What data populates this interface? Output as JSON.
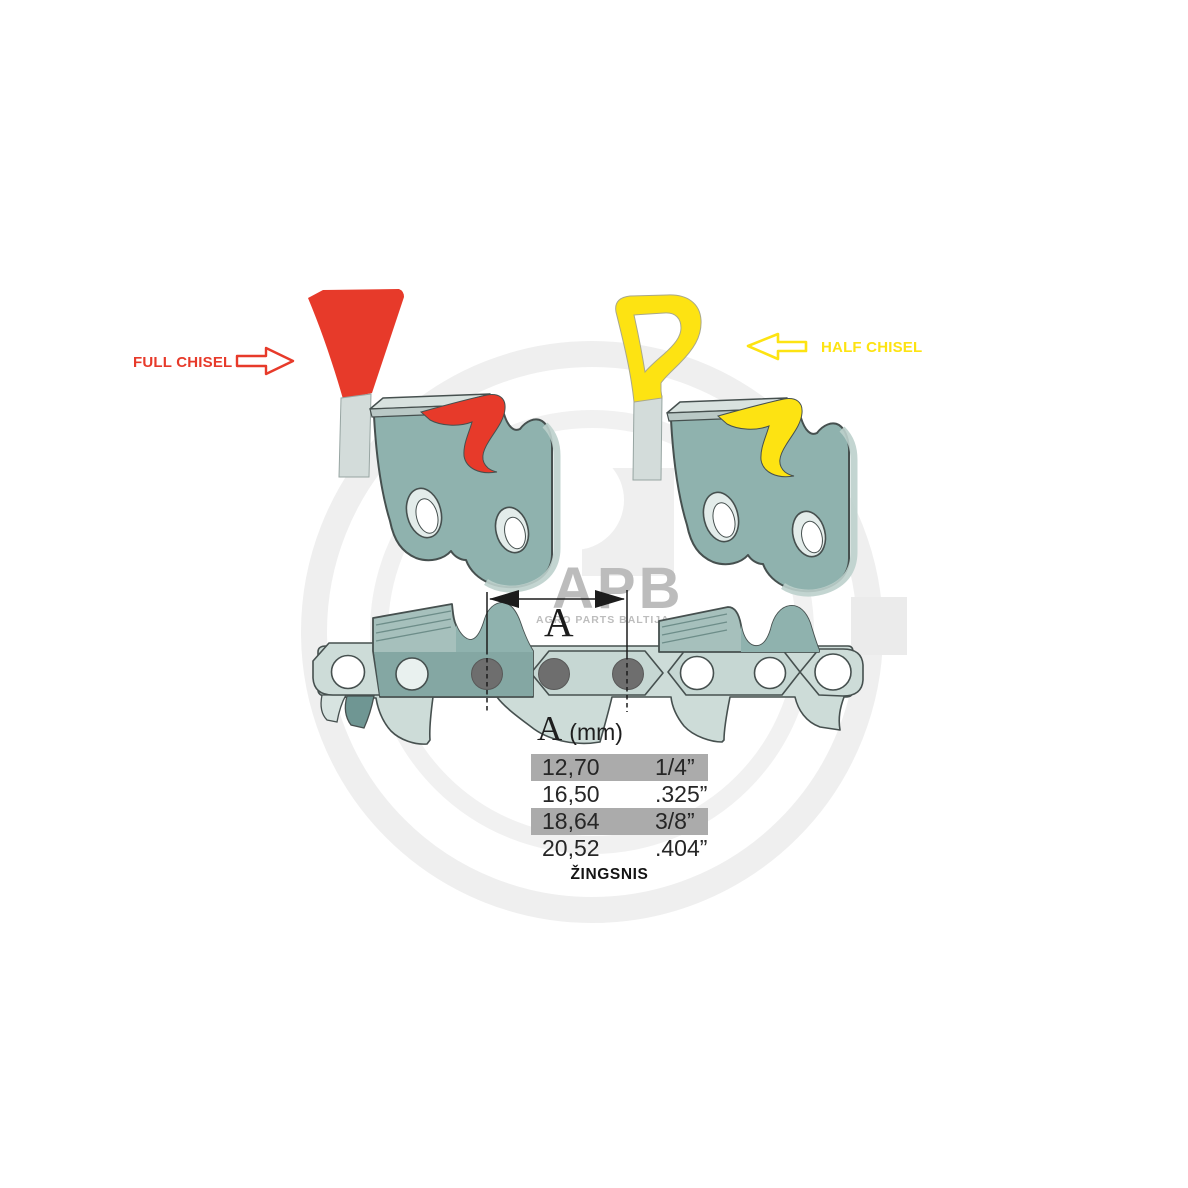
{
  "labels": {
    "full_chisel": "FULL CHISEL",
    "half_chisel": "HALF CHISEL",
    "dimension_letter": "A",
    "pitch_caption": "ŽINGSNIS"
  },
  "watermark": {
    "brand": "APB",
    "brand_subtitle": "AGRO PARTS BALTIJA"
  },
  "pitch_table": {
    "header": {
      "symbol": "A",
      "unit": "(mm)"
    },
    "columns": [
      "millimeters",
      "inches"
    ],
    "rows": [
      {
        "mm": "12,70",
        "inches": "1/4”",
        "highlighted": true
      },
      {
        "mm": "16,50",
        "inches": ".325”",
        "highlighted": false
      },
      {
        "mm": "18,64",
        "inches": "3/8”",
        "highlighted": true
      },
      {
        "mm": "20,52",
        "inches": ".404”",
        "highlighted": false
      }
    ]
  },
  "colors": {
    "full_chisel_red": "#e73a2a",
    "half_chisel_yellow": "#fde312",
    "row_highlight_gray": "#ababab",
    "link_teal": "#8fb2ae",
    "link_light": "#cddcd8",
    "outline": "#46504f",
    "dimension_black": "#1c1c1c",
    "watermark_gray": "#bcbcbc"
  }
}
